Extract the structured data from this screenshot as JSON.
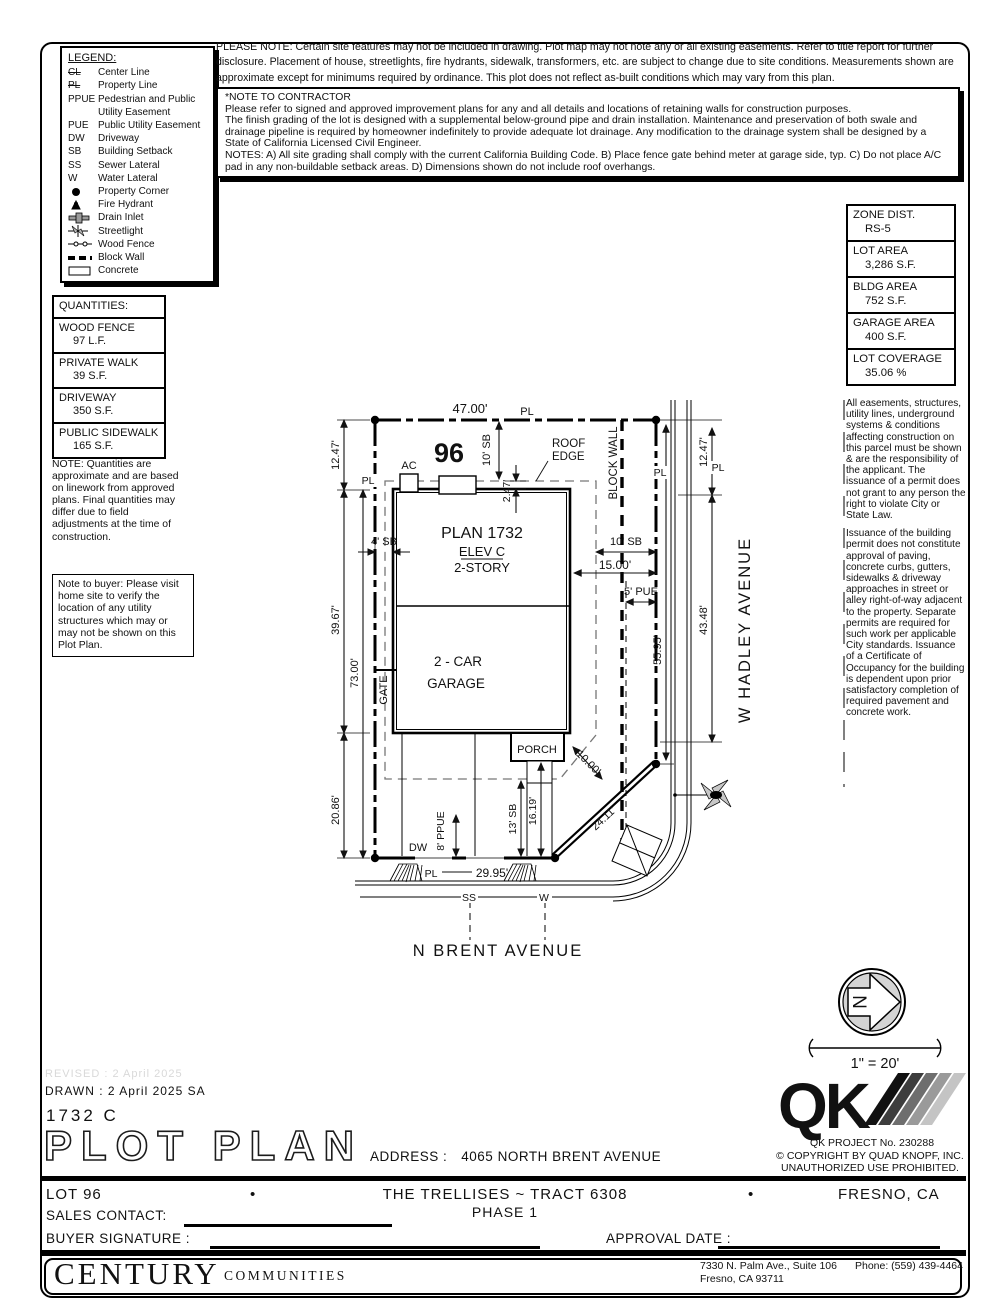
{
  "legend": {
    "title": "LEGEND:",
    "abbr_items": [
      {
        "abbr": "CL",
        "label": "Center Line"
      },
      {
        "abbr": "PL",
        "label": "Property Line"
      },
      {
        "abbr": "PPUE",
        "label": "Pedestrian and Public Utility Easement"
      },
      {
        "abbr": "PUE",
        "label": "Public Utility Easement"
      },
      {
        "abbr": "DW",
        "label": "Driveway"
      },
      {
        "abbr": "SB",
        "label": "Building Setback"
      },
      {
        "abbr": "SS",
        "label": "Sewer Lateral"
      },
      {
        "abbr": "W",
        "label": "Water Lateral"
      }
    ],
    "symbol_items": [
      {
        "icon": "property-corner-icon",
        "label": "Property Corner"
      },
      {
        "icon": "fire-hydrant-icon",
        "label": "Fire Hydrant"
      },
      {
        "icon": "drain-inlet-icon",
        "label": "Drain Inlet"
      },
      {
        "icon": "streetlight-icon",
        "label": "Streetlight"
      },
      {
        "icon": "wood-fence-icon",
        "label": "Wood Fence"
      },
      {
        "icon": "block-wall-icon",
        "label": "Block Wall"
      },
      {
        "icon": "concrete-icon",
        "label": "Concrete"
      }
    ]
  },
  "notes": {
    "please_note": "PLEASE NOTE:  Certain site features may not be included in drawing.  Plot map may not note any or all existing easements. Refer to title report for further disclosure.  Placement of house, streetlights, fire hydrants, sidewalk, transformers, etc. are subject to change due to site conditions.  Measurements shown are approximate except for minimums required by ordinance.  This plot does not reflect as-built conditions which may vary from this plan.",
    "contractor_title": "*NOTE TO CONTRACTOR",
    "contractor_body1": "Please refer to signed and approved improvement plans for any and all details and locations of retaining walls for construction purposes.",
    "contractor_body2": "The finish grading of the lot is designed with a supplemental below-ground pipe and drain installation.  Maintenance and preservation of both swale and drainage pipeline is required by homeowner indefinitely to provide adequate lot drainage.  Any modification to the drainage system shall be designed by a State of California Licensed Civil Engineer.",
    "contractor_body3": "NOTES:  A) All site grading shall comply with the current California Building Code.  B) Place fence gate behind meter at garage side, typ.  C) Do not place A/C pad in any non-buildable setback areas.  D) Dimensions shown do not include roof overhangs.",
    "quantities_note": "NOTE: Quantities are approximate and are based on linework from approved plans.  Final quantities may differ due to field adjustments at the time of construction.",
    "buyer_note": "Note to buyer: Please visit home site to verify the location of any utility structures which may or may not be shown on this Plot Plan.",
    "easements_1": "All easements, structures, utility lines, underground systems & conditions affecting construction on this parcel must be shown & are the responsibility of the applicant. The issuance of a permit does not grant to any person the right to violate City or State Law.",
    "easements_2": "Issuance of the building permit does not constitute approval of paving, concrete curbs, gutters, sidewalks & driveway approaches in street or alley right-of-way adjacent to the property. Separate permits are required for such work per applicable City standards. Issuance of a Certificate of Occupancy for the building is dependent upon prior satisfactory completion of required pavement and concrete work."
  },
  "zone_boxes": [
    {
      "label": "ZONE DIST.",
      "value": "RS-5"
    },
    {
      "label": "LOT AREA",
      "value": "3,286 S.F."
    },
    {
      "label": "BLDG AREA",
      "value": "752 S.F."
    },
    {
      "label": "GARAGE AREA",
      "value": "400 S.F."
    },
    {
      "label": "LOT COVERAGE",
      "value": "35.06 %"
    }
  ],
  "quantities": {
    "title": "QUANTITIES:",
    "items": [
      {
        "label": "WOOD FENCE",
        "value": "97 L.F."
      },
      {
        "label": "PRIVATE WALK",
        "value": "39 S.F."
      },
      {
        "label": "DRIVEWAY",
        "value": "350 S.F."
      },
      {
        "label": "PUBLIC SIDEWALK",
        "value": "165 S.F."
      }
    ]
  },
  "drawing": {
    "lot_number": "96",
    "streets": {
      "west": "W HADLEY AVENUE",
      "south": "N BRENT AVENUE"
    },
    "house": {
      "plan": "PLAN 1732",
      "elev": "ELEV C",
      "story": "2-STORY",
      "garage1": "2 - CAR",
      "garage2": "GARAGE",
      "porch": "PORCH",
      "ac": "AC"
    },
    "labels": {
      "pl": "PL",
      "gate": "GATE",
      "dw": "DW",
      "ss": "SS",
      "w": "W",
      "block_wall": "BLOCK WALL",
      "roof1": "ROOF",
      "roof2": "EDGE"
    },
    "dims": {
      "lot_width": "47.00'",
      "d1247": "12.47'",
      "d3967": "39.67'",
      "d73": "73.00'",
      "d2086": "20.86'",
      "d247": "2.47'",
      "sb10": "10' SB",
      "sb4": "4' SB",
      "d15": "15.00'",
      "pue5": "5' PUE",
      "d4348": "43.48'",
      "d5595": "55.95'",
      "d10": "10.00'",
      "d2411": "24.11'",
      "sb13": "13' SB",
      "d1619": "16.19'",
      "ppue8": "8' PPUE",
      "d2995": "29.95'"
    }
  },
  "north": {
    "n": "N",
    "scale": "1\" = 20'"
  },
  "qk": {
    "letters": "QK",
    "project": "QK PROJECT No. 230288",
    "copyright": "©  COPYRIGHT BY QUAD KNOPF, INC.",
    "prohibited": "UNAUTHORIZED USE PROHIBITED."
  },
  "titleblock": {
    "revised": "REVISED :  2 April 2025",
    "drawn": "DRAWN :  2 April 2025  SA",
    "plan_code": "1732  C",
    "title": "PLOT PLAN",
    "address_label": "ADDRESS :",
    "address": "4065 NORTH BRENT AVENUE",
    "lot": "LOT 96",
    "separator": "•",
    "community": "THE TRELLISES ~ TRACT 6308",
    "phase": "PHASE 1",
    "city": "FRESNO, CA",
    "sales_label": "SALES CONTACT:",
    "buyer_label": "BUYER SIGNATURE :",
    "approval_label": "APPROVAL DATE :"
  },
  "footer": {
    "brand1": "CENTURY",
    "brand2": "COMMUNITIES",
    "address1": "7330 N. Palm Ave., Suite 106",
    "phone": "Phone:  (559) 439-4464",
    "address2": "Fresno, CA  93711"
  }
}
